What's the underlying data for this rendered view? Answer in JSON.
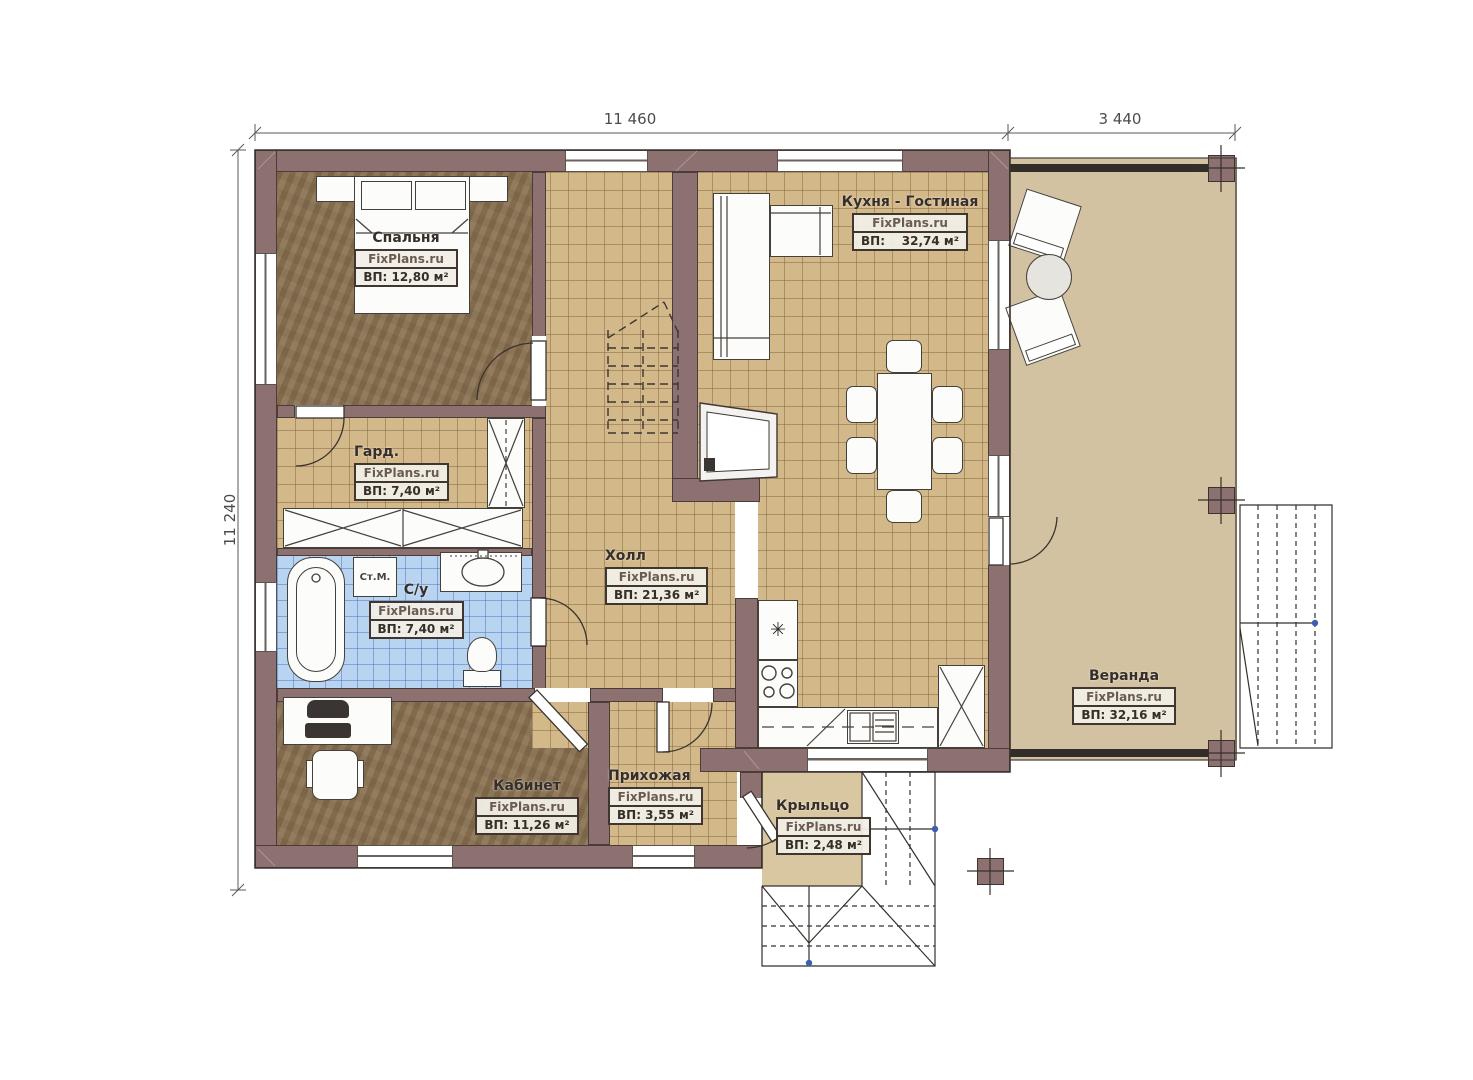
{
  "site_watermark": "FixPlans.ru",
  "dimensions": {
    "width_main": "11 460",
    "width_veranda": "3 440",
    "height": "11 240"
  },
  "rooms": {
    "bedroom": {
      "name": "Спальня",
      "area": "ВП: 12,80 м²"
    },
    "wardrobe": {
      "name": "Гард.",
      "area": "ВП: 7,40 м²"
    },
    "bathroom": {
      "name": "С/у",
      "area": "ВП: 7,40 м²"
    },
    "hall": {
      "name": "Холл",
      "area": "ВП: 21,36 м²"
    },
    "office": {
      "name": "Кабинет",
      "area": "ВП: 11,26 м²"
    },
    "entry": {
      "name": "Прихожая",
      "area": "ВП: 3,55 м²"
    },
    "kitchen": {
      "name": "Кухня - Гостиная",
      "area_label": "ВП:",
      "area_value": "32,74 м²"
    },
    "porch": {
      "name": "Крыльцо",
      "area": "ВП: 2,48 м²"
    },
    "veranda": {
      "name": "Веранда",
      "area": "ВП: 32,16 м²"
    }
  },
  "labels": {
    "washing_machine": "Ст.М."
  },
  "icons": {
    "fridge_snowflake": "✳"
  },
  "colors": {
    "wall": "#8c7170",
    "tile_floor": "#d3b88a",
    "bath_tile": "#b9d4f1",
    "wood_floor": "#8d7555",
    "veranda_floor": "#d3c2a2",
    "anchor_dot": "#3c5fae"
  }
}
